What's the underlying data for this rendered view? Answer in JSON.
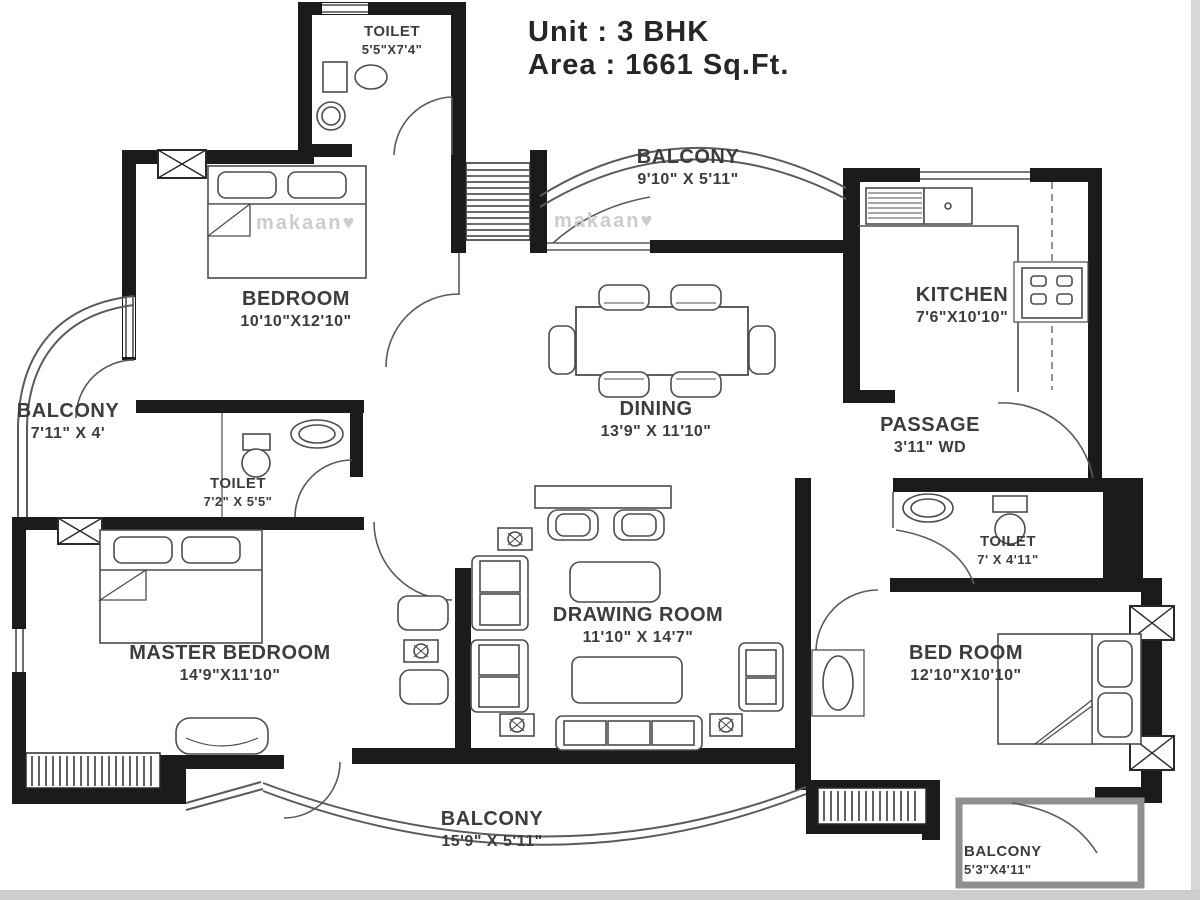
{
  "title": {
    "unit_label": "Unit : 3 BHK",
    "area_label": "Area : 1661 Sq.Ft."
  },
  "watermark": {
    "text": "makaan",
    "heart": "♥"
  },
  "rooms": [
    {
      "id": "toilet-top",
      "name": "TOILET",
      "dims": "5'5\"X7'4\""
    },
    {
      "id": "balcony-top",
      "name": "BALCONY",
      "dims": "9'10\" X 5'11\""
    },
    {
      "id": "kitchen",
      "name": "KITCHEN",
      "dims": "7'6\"X10'10\""
    },
    {
      "id": "bedroom",
      "name": "BEDROOM",
      "dims": "10'10\"X12'10\""
    },
    {
      "id": "balcony-left",
      "name": "BALCONY",
      "dims": "7'11\" X 4'"
    },
    {
      "id": "toilet-mid",
      "name": "TOILET",
      "dims": "7'2\" X 5'5\""
    },
    {
      "id": "dining",
      "name": "DINING",
      "dims": "13'9\" X 11'10\""
    },
    {
      "id": "passage",
      "name": "PASSAGE",
      "dims": "3'11\" WD"
    },
    {
      "id": "toilet-right",
      "name": "TOILET",
      "dims": "7' X 4'11\""
    },
    {
      "id": "master-bedroom",
      "name": "MASTER BEDROOM",
      "dims": "14'9\"X11'10\""
    },
    {
      "id": "drawing-room",
      "name": "DRAWING ROOM",
      "dims": "11'10\" X 14'7\""
    },
    {
      "id": "bed-room",
      "name": "BED ROOM",
      "dims": "12'10\"X10'10\""
    },
    {
      "id": "balcony-bottom",
      "name": "BALCONY",
      "dims": "15'9\" X 5'11\""
    },
    {
      "id": "balcony-bottom-right",
      "name": "BALCONY",
      "dims": "5'3\"X4'11\""
    }
  ],
  "colors": {
    "wall": "#1b1b1b",
    "line": "#4d4d4d",
    "text": "#3c3c3c",
    "watermark": "#cccccc",
    "background": "#ffffff"
  }
}
